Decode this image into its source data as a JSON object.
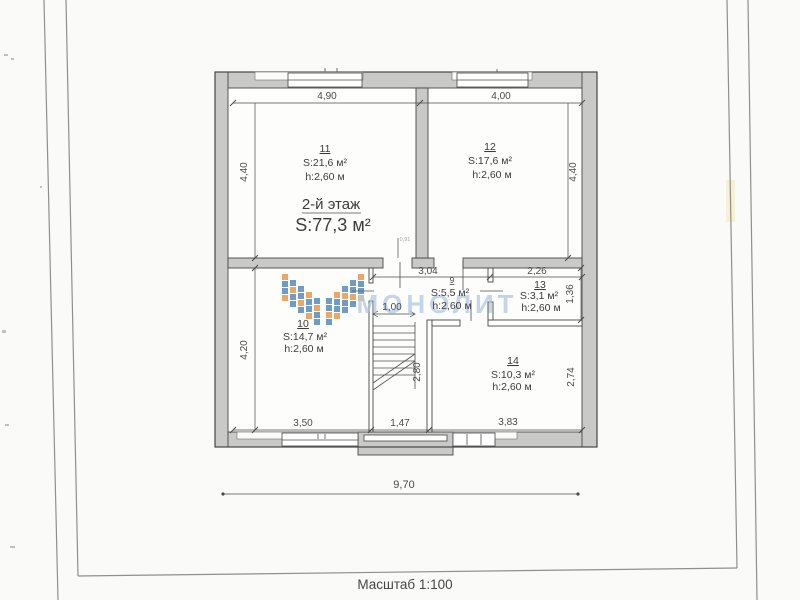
{
  "page": {
    "scale_label": "Масштаб 1:100"
  },
  "plan": {
    "floor_label": "2-й этаж",
    "floor_area": "S:77,3 м²",
    "door_width_note": "0,91",
    "rooms": {
      "r9": {
        "number": "9",
        "area": "S:5,5 м²",
        "height": "h:2,60 м"
      },
      "r10": {
        "number": "10",
        "area": "S:14,7 м²",
        "height": "h:2,60 м"
      },
      "r11": {
        "number": "11",
        "area": "S:21,6 м²",
        "height": "h:2,60 м"
      },
      "r12": {
        "number": "12",
        "area": "S:17,6 м²",
        "height": "h:2,60 м"
      },
      "r13": {
        "number": "13",
        "area": "S:3,1 м²",
        "height": "h:2,60 м"
      },
      "r14": {
        "number": "14",
        "area": "S:10,3 м²",
        "height": "h:2,60 м"
      }
    },
    "dims": {
      "top_left": "4,90",
      "top_right": "4,00",
      "side_left_upper": "4,40",
      "side_right_upper": "4,40",
      "hall_width": "3,04",
      "room13_width": "2,26",
      "room13_depth": "1,36",
      "stair_width": "1,00",
      "stair_depth": "2,80",
      "room14_depth": "2,74",
      "side_left_lower": "4,20",
      "bottom_left": "3,50",
      "bottom_middle": "1,47",
      "bottom_right": "3,83",
      "overall_width": "9,70"
    }
  },
  "watermark": {
    "text": "МОНОЛИТ"
  },
  "colors": {
    "paper": "#fafaf8",
    "ink": "#3c3c3c",
    "dim": "#4a4a4a",
    "wall_fill": "#c9c9c8",
    "wall_stroke": "#474747",
    "frame": "#8f8f8f",
    "watermark_blue": "#a9c4de",
    "logo_orange": "#e0872f",
    "logo_blue": "#3b76ae"
  }
}
